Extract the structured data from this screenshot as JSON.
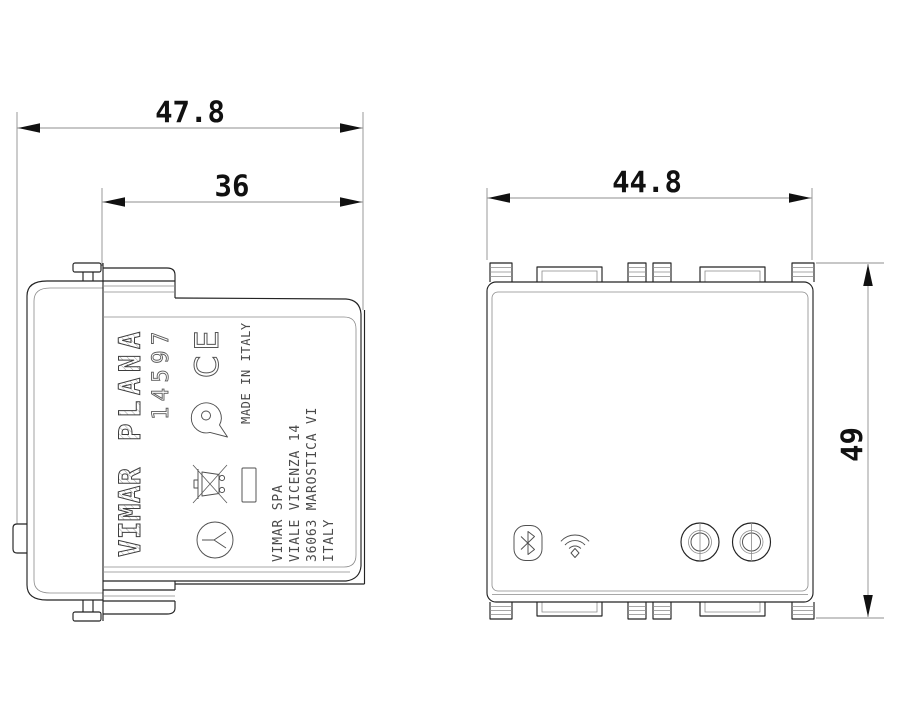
{
  "page": {
    "background": "#ffffff"
  },
  "colors": {
    "outline": "#232323",
    "thin_line": "#8a8a8a",
    "dimension_line": "#8f8f8f",
    "dimension_text": "#111111",
    "label_text": "#4a4a4a"
  },
  "dimensions": {
    "side_total_depth": "47.8",
    "side_front_depth": "36",
    "front_width": "44.8",
    "front_height": "49"
  },
  "side_view": {
    "brand": "VIMAR",
    "series": "PLANA",
    "article_number": "14597",
    "ce_mark": "CE",
    "made_in": "MADE IN ITALY",
    "address": [
      "VIMAR SPA",
      "VIALE VICENZA 14",
      "36063 MAROSTICA VI",
      "ITALY"
    ]
  },
  "front_view": {
    "icons": {
      "bluetooth": "bluetooth-icon",
      "wifi": "wifi-icon"
    },
    "controls": {
      "left": "pushbutton-left",
      "right": "pushbutton-right"
    }
  }
}
